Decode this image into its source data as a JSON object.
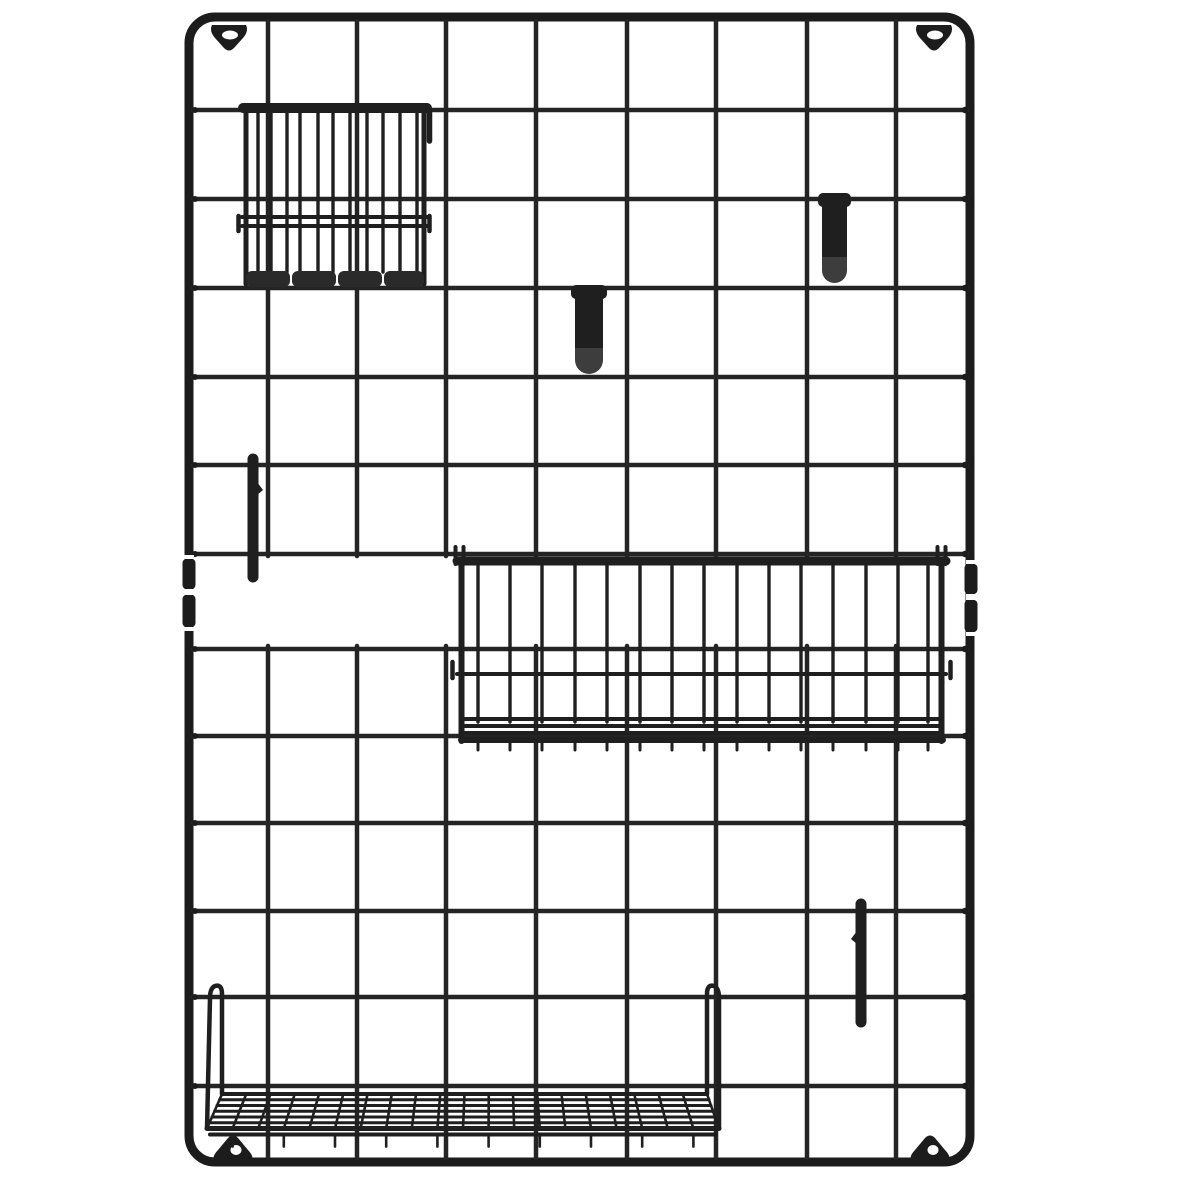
{
  "image": {
    "subject": "black metal wire grid wall organizer panel with accessories",
    "accessories": [
      "pen-cup basket",
      "j-hook clip",
      "j-hook clip",
      "hanging rod",
      "hanging rod",
      "storage basket",
      "wire shelf"
    ]
  },
  "scene": {
    "canvas": {
      "w": 1200,
      "h": 1200
    },
    "colors": {
      "background": "#ffffff",
      "frame": "#1c1c1c",
      "wire": "#242424",
      "acc": "#1f1f1f",
      "light": "#3d3d3d",
      "base": "#2a2a2a"
    },
    "frame": {
      "x": 189,
      "y": 17,
      "w": 781,
      "h": 1145,
      "rx": 26,
      "sw": 9
    },
    "grid": {
      "rows": [
        110,
        199,
        288,
        377,
        465,
        554,
        649,
        736,
        823,
        911,
        997,
        1086
      ],
      "cols": [
        268,
        357,
        446,
        536,
        627,
        716,
        807,
        896
      ],
      "hx1": 193,
      "hx2": 967,
      "vtop": [
        21,
        556
      ],
      "vbot": [
        646,
        1158
      ],
      "wire_w": 4.5
    },
    "tabs": [
      {
        "cx": 229,
        "cy": 34,
        "dir": "down",
        "hole": [
          230,
          35
        ]
      },
      {
        "cx": 934,
        "cy": 34,
        "dir": "down",
        "hole": [
          935,
          35
        ]
      },
      {
        "cx": 233,
        "cy": 1149,
        "dir": "up",
        "hole": [
          236,
          1150
        ]
      },
      {
        "cx": 930,
        "cy": 1149,
        "dir": "up",
        "hole": [
          933,
          1150
        ]
      }
    ],
    "connectors": {
      "gaps": [
        [
          184,
          555,
          10,
          4
        ],
        [
          184,
          589,
          10,
          6
        ],
        [
          184,
          627,
          10,
          4
        ],
        [
          966,
          560,
          9,
          4
        ],
        [
          966,
          594,
          9,
          6
        ],
        [
          966,
          632,
          9,
          4
        ]
      ],
      "clips": [
        [
          182.5,
          559,
          13,
          30
        ],
        [
          182.5,
          595,
          13,
          32
        ],
        [
          964.5,
          564,
          13,
          30
        ],
        [
          964.5,
          600,
          13,
          32
        ]
      ]
    },
    "pen_cup": {
      "hook": [
        429.5,
        111,
        141,
        5.5
      ],
      "bars": [
        258,
        271,
        287,
        300,
        318,
        333,
        350,
        367,
        383,
        400,
        417
      ],
      "bar_y": [
        112,
        272
      ],
      "sides": [
        246,
        424
      ],
      "side_y": [
        110,
        284
      ],
      "mids": [
        217,
        226
      ],
      "mid_span": [
        242,
        428
      ],
      "stubs": [
        [
          238.5,
          216,
          231
        ],
        [
          429.5,
          216,
          231
        ]
      ],
      "base_y": 271,
      "base_h": 16,
      "base_segments": [
        [
          246,
          290
        ],
        [
          292,
          336
        ],
        [
          338,
          382
        ],
        [
          384,
          424
        ]
      ],
      "rim": [
        243,
        427,
        108,
        10
      ]
    },
    "hooks": [
      {
        "x": 818,
        "y": 193,
        "w": 33,
        "bottom": 283
      },
      {
        "x": 571,
        "y": 285,
        "w": 36,
        "bottom": 374
      }
    ],
    "rods": [
      {
        "x": 253,
        "y1": 459,
        "y2": 577,
        "w": 11,
        "spur": [
          257,
          482,
          263,
          490,
          257,
          495
        ]
      },
      {
        "x": 861,
        "y1": 904,
        "y2": 1022,
        "w": 11,
        "spur": [
          857,
          931,
          851,
          939,
          857,
          944
        ]
      }
    ],
    "basket": {
      "rim": [
        457,
        946,
        561,
        9
      ],
      "clips": [
        455.5,
        463.5,
        937.5,
        945.5
      ],
      "clip_y": [
        547,
        564
      ],
      "sides": [
        461.5,
        941.5
      ],
      "side_y": [
        561,
        741
      ],
      "bars": [
        478,
        510,
        542,
        575,
        607,
        640,
        672,
        704,
        737,
        769,
        801,
        833,
        866,
        898,
        928
      ],
      "bar_y": [
        565,
        722
      ],
      "mid": 674,
      "mid_span": [
        457,
        946
      ],
      "side_stubs": [
        452.5,
        950.5
      ],
      "stub_y": [
        662,
        678
      ],
      "base": [
        [
          463,
          941,
          719,
          4
        ],
        [
          463,
          941,
          726,
          4
        ],
        [
          463,
          941,
          733,
          4
        ],
        [
          461,
          943,
          740,
          6
        ]
      ],
      "tick_y": [
        742,
        750
      ]
    },
    "shelf": {
      "back": {
        "x1": 222,
        "x2": 707,
        "y": 1094
      },
      "front": {
        "x1": 207,
        "x2": 719,
        "y": 1128.5
      },
      "rows": 6,
      "cols": 21,
      "hooks": [
        {
          "x": 222,
          "dir": -1,
          "fx": 207
        },
        {
          "x": 707,
          "dir": 1,
          "fx": 719
        }
      ],
      "front2_dy": 6,
      "tick_len": 12
    }
  }
}
